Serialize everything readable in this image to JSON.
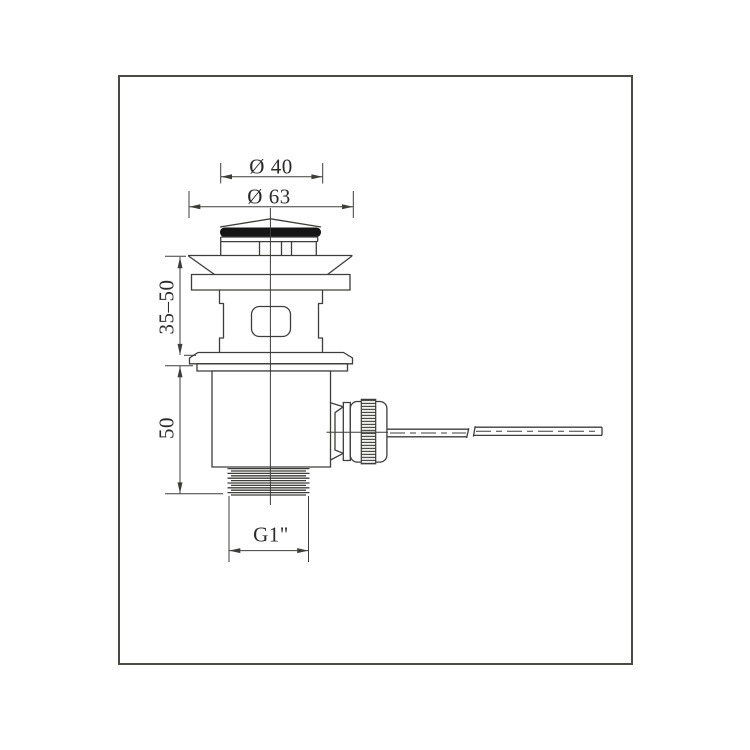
{
  "drawing": {
    "type": "technical-drawing-pop-up-drain",
    "line_color": "#3d3d3b",
    "frame_color": "#4a4a45",
    "gasket_color": "#161616",
    "labels": {
      "cap_diameter": "Ø 40",
      "flange_diameter": "Ø 63",
      "adjustable_height": "35–50",
      "lower_height": "50",
      "thread_size": "G1\""
    }
  }
}
